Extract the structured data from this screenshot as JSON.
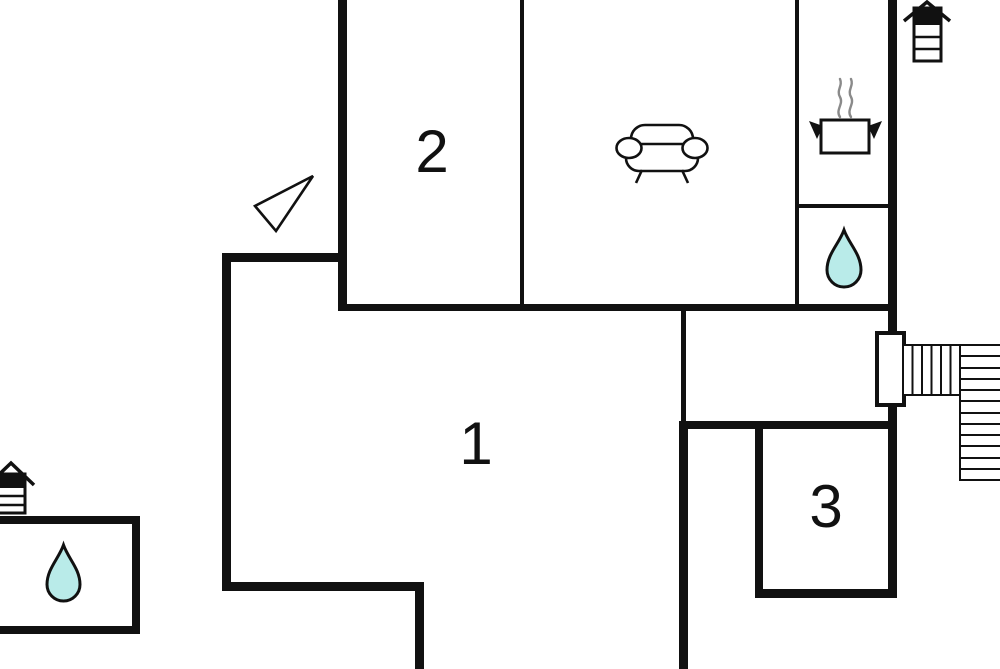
{
  "plan": {
    "type": "floor-plan"
  },
  "rooms": [
    {
      "number": "1"
    },
    {
      "number": "2"
    },
    {
      "number": "3"
    }
  ],
  "icons": {
    "sofa": "sofa-icon",
    "stove_pot": "stove-pot-icon",
    "water_drop_bathroom": "water-drop-icon",
    "water_drop_annex": "water-drop-icon",
    "chimney_top_right": "chimney-icon",
    "chimney_annex": "chimney-icon",
    "stairs": "stairs-icon",
    "entrance_arrow": "entrance-arrow-icon",
    "door_opening": "door-icon"
  },
  "colors": {
    "wall": "#111111",
    "water_fill": "#b9ebe9",
    "steam": "#8a8a8a",
    "background": "#ffffff",
    "label": "#111111"
  }
}
